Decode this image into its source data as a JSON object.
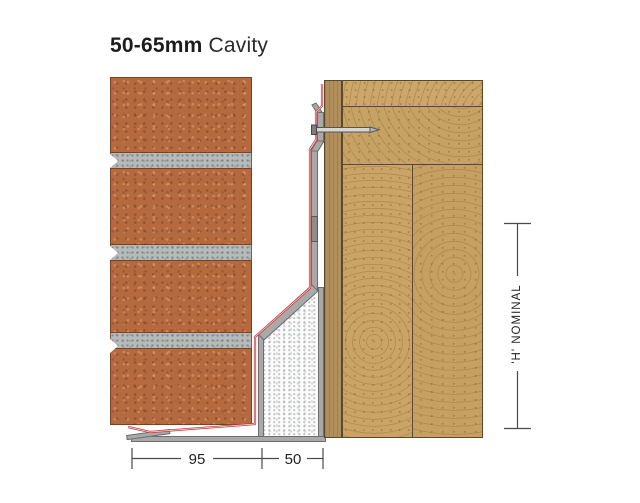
{
  "title": {
    "range": "50-65mm",
    "label": " Cavity"
  },
  "annotations": {
    "dim_brick": "95",
    "dim_cavity": "50",
    "dim_height": "'H' NOMINAL"
  },
  "colors": {
    "background": "#ffffff",
    "brick": "#b4693f",
    "mortar": "#b6bab9",
    "timber": "#c9a466",
    "sheathing": "#b08f5c",
    "steel": "#a9a9a9",
    "insulation": "#fcfcfc",
    "membrane_dpc": "#c23c3c",
    "dimension_lines": "#4a4a4a",
    "text": "#1c1c1c"
  }
}
